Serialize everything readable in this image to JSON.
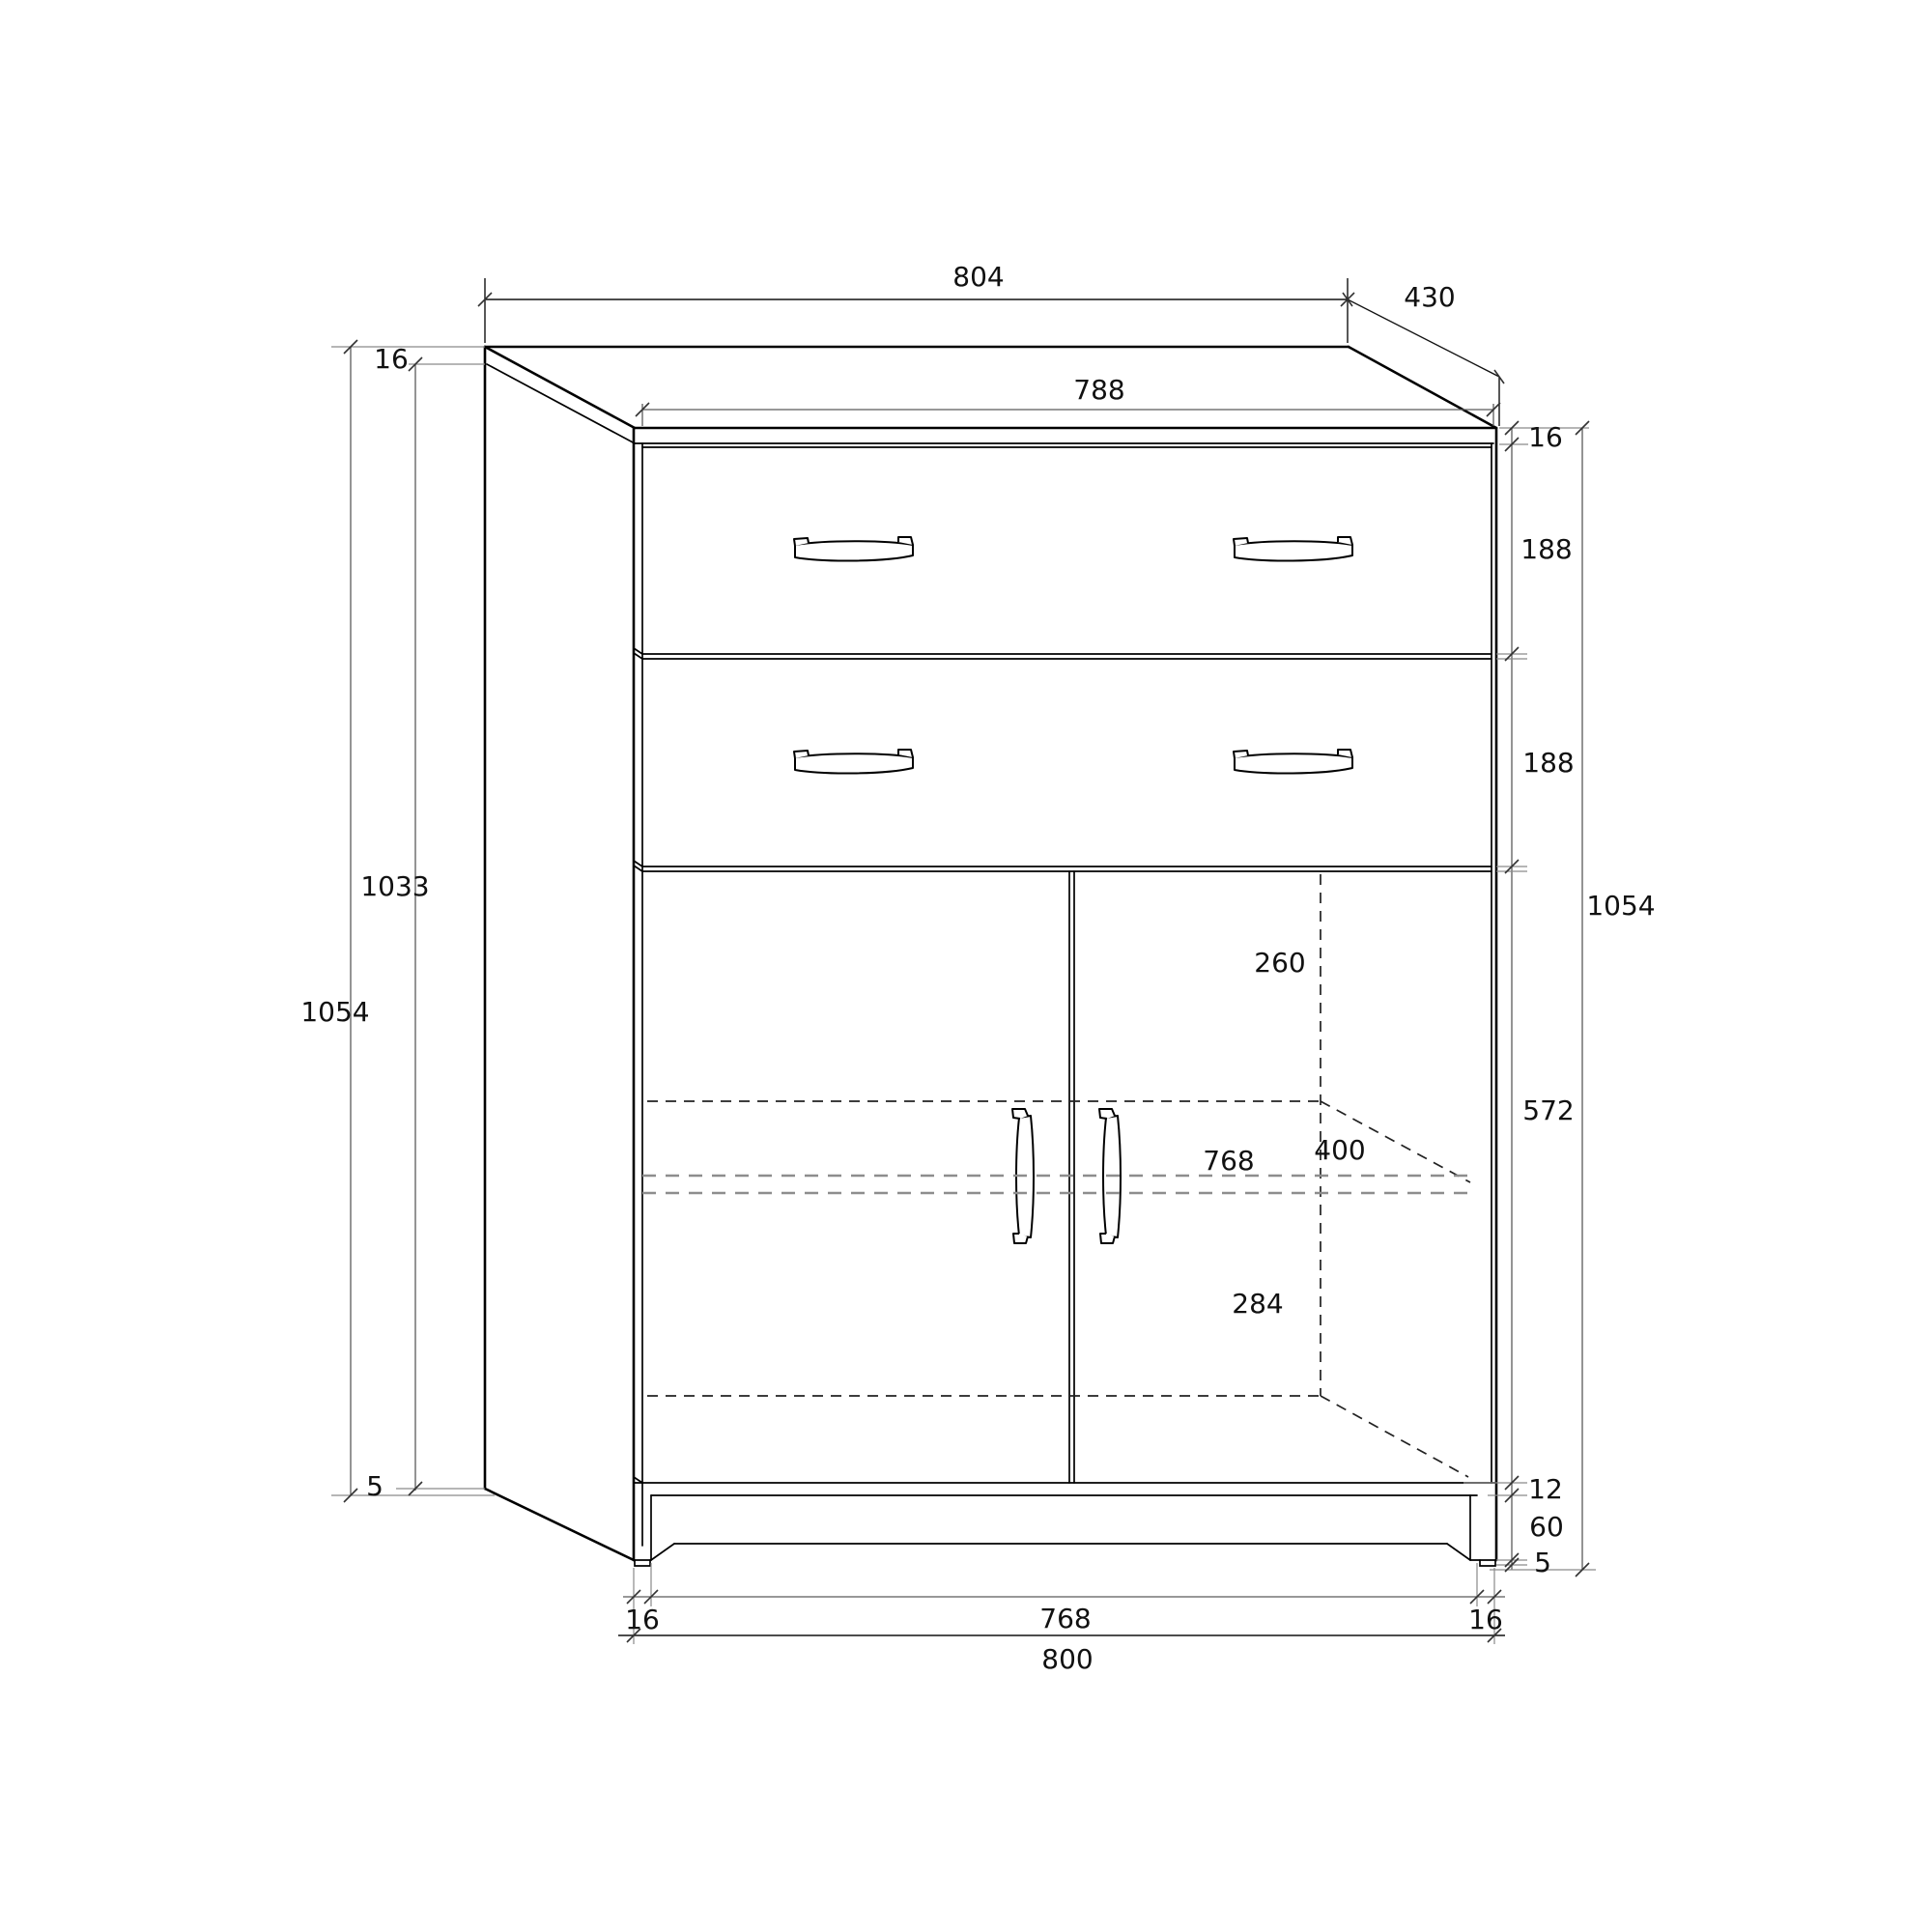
{
  "drawing": {
    "type": "furniture-technical-drawing",
    "subject": "two-drawer two-door cabinet, front view with perspective side and hidden shelf lines",
    "background_color": "#ffffff",
    "line_color": "#000000",
    "dimension_line_color": "#5a5a5a",
    "hidden_line_color": "#8d8d8d",
    "dimensions": {
      "top_panel_width": {
        "value": "804",
        "meaning": "overall top panel width"
      },
      "depth": {
        "value": "430",
        "meaning": "cabinet depth"
      },
      "front_inner_width_top": {
        "value": "788",
        "meaning": "width between side panel inner faces at top"
      },
      "top_thickness_right": {
        "value": "16",
        "meaning": "top panel thickness (right chain)"
      },
      "drawer1_height": {
        "value": "188",
        "meaning": "upper drawer front height"
      },
      "drawer2_height": {
        "value": "188",
        "meaning": "lower drawer front height"
      },
      "height_total_right": {
        "value": "1054",
        "meaning": "overall height (right chain)"
      },
      "door_section_height": {
        "value": "572",
        "meaning": "door front height"
      },
      "bottom_panel_edge": {
        "value": "12",
        "meaning": "bottom panel edge below doors"
      },
      "plinth_height": {
        "value": "60",
        "meaning": "plinth recess height"
      },
      "glide_right": {
        "value": "5",
        "meaning": "floor glide height (right chain)"
      },
      "top_thickness_left": {
        "value": "16",
        "meaning": "top panel thickness (left chain)"
      },
      "side_panel_height": {
        "value": "1033",
        "meaning": "side panel height"
      },
      "height_total_left": {
        "value": "1054",
        "meaning": "overall height (left chain)"
      },
      "glide_left": {
        "value": "5",
        "meaning": "floor glide height (left chain)"
      },
      "space_above_shelf": {
        "value": "260",
        "meaning": "clear height above middle shelf"
      },
      "shelf_depth": {
        "value": "400",
        "meaning": "middle shelf depth"
      },
      "interior_width": {
        "value": "768",
        "meaning": "interior width at shelf"
      },
      "space_below_shelf": {
        "value": "284",
        "meaning": "clear height below middle shelf"
      },
      "side_thickness_bottom_left": {
        "value": "16",
        "meaning": "left side panel thickness at base"
      },
      "interior_width_bottom": {
        "value": "768",
        "meaning": "interior width at base"
      },
      "side_thickness_bottom_right": {
        "value": "16",
        "meaning": "right side panel thickness at base"
      },
      "base_width": {
        "value": "800",
        "meaning": "overall carcass width"
      }
    }
  }
}
